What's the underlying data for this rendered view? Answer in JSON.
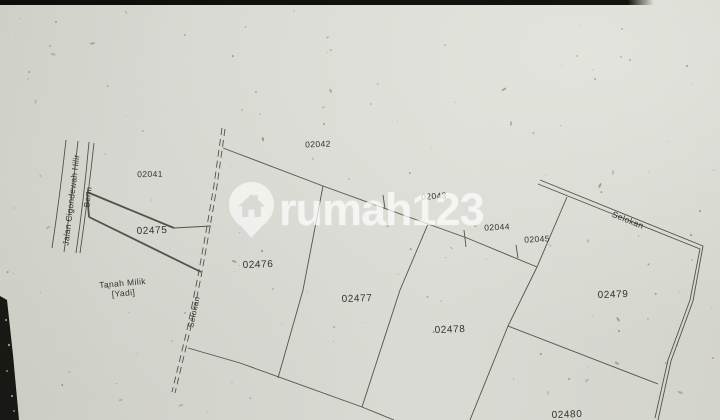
{
  "map": {
    "parcel_labels": {
      "p02041": "02041",
      "p02042": "02042",
      "p02043": "02043",
      "p02044": "02044",
      "p02045": "02045",
      "p02475": "02475",
      "p02476": "02476",
      "p02477": "02477",
      "p02478": "02478",
      "p02479": "02479",
      "p02480": "02480"
    },
    "road_label": "Jalan Cigondewah Hilir",
    "berm_label": "Berm",
    "left_ditch_label": "Selokan",
    "right_ditch_label": "Selokan",
    "owner_label_line1": "Tanah Milik",
    "owner_label_line2": "[Yadi]"
  },
  "watermark": {
    "text": "rumah123",
    "logo": "house-pin-icon"
  },
  "colors": {
    "paper": "#d7d8d1",
    "ink": "#3b3b33",
    "watermark": "rgba(255,255,255,0.62)",
    "scan_edge": "#14140f"
  }
}
